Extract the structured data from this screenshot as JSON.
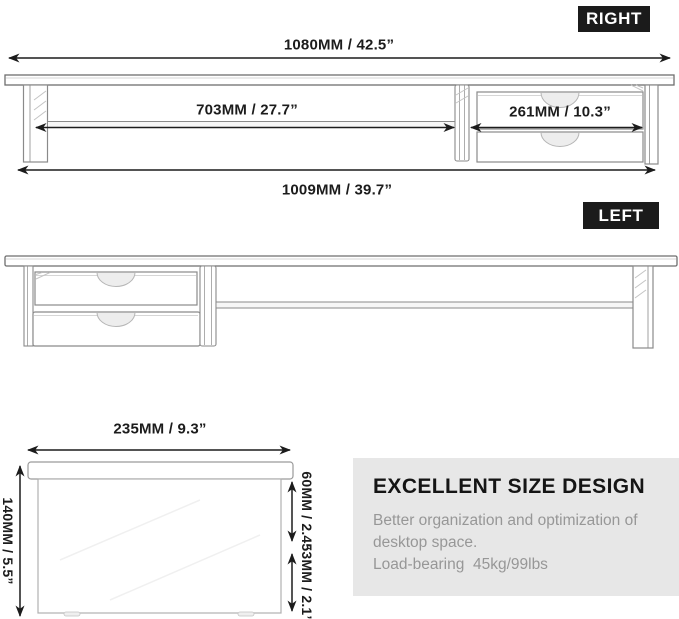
{
  "colors": {
    "background": "#ffffff",
    "badge_bg": "#1b1b1b",
    "badge_text": "#ffffff",
    "dim_text": "#1c1c1c",
    "arrow": "#1c1c1c",
    "drawing_line": "#8a8a8a",
    "info_bg": "#e7e7e7",
    "info_title": "#151515",
    "info_text": "#979797"
  },
  "right_view": {
    "badge": "RIGHT",
    "dim_top": "1080MM / 42.5”",
    "dim_shelf": "703MM / 27.7”",
    "dim_drawer": "261MM / 10.3”",
    "dim_bottom": "1009MM / 39.7”"
  },
  "left_view": {
    "badge": "LEFT"
  },
  "side_view": {
    "dim_width": "235MM / 9.3”",
    "dim_height": "140MM / 5.5”",
    "dim_upper": "60MM / 2.4”",
    "dim_lower": "53MM / 2.1”"
  },
  "info_box": {
    "title": "EXCELLENT SIZE DESIGN",
    "line1": "Better organization and optimization of",
    "line2": "desktop space.",
    "line3": "Load-bearing  45kg/99lbs"
  }
}
